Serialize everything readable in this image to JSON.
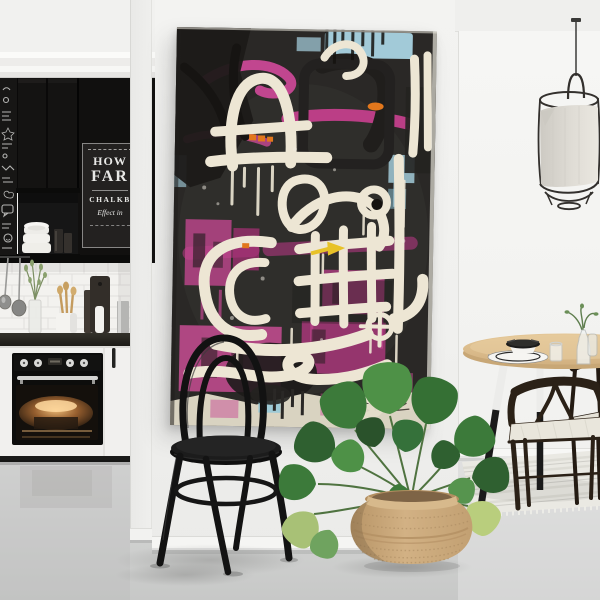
{
  "scene": {
    "title": "Scandinavian interior with abstract artwork",
    "areas": {
      "left": "black kitchen with chalkboard wall",
      "center": "gallery wall with abstract painting, bentwood chair and monstera plant",
      "right": "dining nook with pendant lamp and wishbone chairs"
    }
  },
  "kitchen": {
    "poster": {
      "line_top": "HOW",
      "line_main": "FAR",
      "line_sub": "CHALKB",
      "line_script": "Effect in"
    }
  },
  "artwork": {
    "style": "abstract graffiti painting on canvas",
    "palette": {
      "background": "#2A2826",
      "pink": "#C1468F",
      "magenta": "#B23780",
      "cream": "#EDE6D4",
      "sky_blue": "#A9D3E2",
      "orange": "#E2771C",
      "yellow": "#E8C228"
    }
  },
  "palette": {
    "wall": "#F1F1EF",
    "floor": "#D5D6D5",
    "cabinets": "#131211",
    "chair": "#141414",
    "basket": "#CDAB7E",
    "foliage": "#3C7A3A",
    "table_wood": "#DCBE8F",
    "lamp_fabric": "#DFDCD5"
  }
}
